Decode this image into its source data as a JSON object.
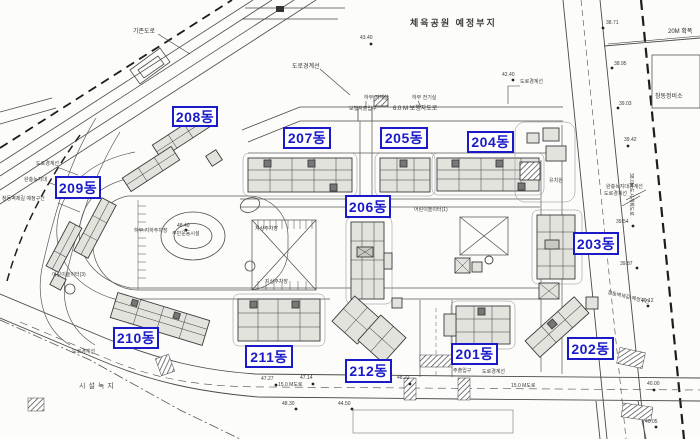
{
  "colors": {
    "label_blue": "#1a1ac8",
    "line_ink": "#3c3c3c",
    "building_fill": "#e3e3de"
  },
  "building_labels": [
    {
      "id": "208",
      "text": "208동"
    },
    {
      "id": "207",
      "text": "207동"
    },
    {
      "id": "205",
      "text": "205동"
    },
    {
      "id": "204",
      "text": "204동"
    },
    {
      "id": "209",
      "text": "209동"
    },
    {
      "id": "206",
      "text": "206동"
    },
    {
      "id": "203",
      "text": "203동"
    },
    {
      "id": "210",
      "text": "210동"
    },
    {
      "id": "211",
      "text": "211동"
    },
    {
      "id": "212",
      "text": "212동"
    },
    {
      "id": "201",
      "text": "201동"
    },
    {
      "id": "202",
      "text": "202동"
    }
  ],
  "annotations": [
    {
      "text": "기존도로"
    },
    {
      "text": "체육공원 예정부지"
    },
    {
      "text": "도로경계선"
    },
    {
      "text": "하부 기계실"
    },
    {
      "text": "하부 전기실"
    },
    {
      "text": "보행자출입구"
    },
    {
      "text": "6.0 M 보행자도로"
    },
    {
      "text": "43.40"
    },
    {
      "text": "42.40"
    },
    {
      "text": "도로경계선"
    },
    {
      "text": "20M 확폭"
    },
    {
      "text": "38.71"
    },
    {
      "text": "38.95"
    },
    {
      "text": "39.03"
    },
    {
      "text": "창동정비소"
    },
    {
      "text": "도로경계선"
    },
    {
      "text": "완충녹지대"
    },
    {
      "text": "창동벽제길 예정구간"
    },
    {
      "text": "완충녹지대경계선"
    },
    {
      "text": "도로경계선"
    },
    {
      "text": "39.42"
    },
    {
      "text": "38.0M 도시계획도로"
    },
    {
      "text": "39.54"
    },
    {
      "text": "39.87"
    },
    {
      "text": "유치원"
    },
    {
      "text": "어린이놀이터(1)"
    },
    {
      "text": "주민운동시설"
    },
    {
      "text": "48.40"
    },
    {
      "text": "하부:지하주차장"
    },
    {
      "text": "지상주차장"
    },
    {
      "text": "지상주차장"
    },
    {
      "text": "어린이놀이터(3)"
    },
    {
      "text": "창동벽제길 예정구간"
    },
    {
      "text": "도로경계선"
    },
    {
      "text": "시설녹지"
    },
    {
      "text": "47.27"
    },
    {
      "text": "47.14"
    },
    {
      "text": "48.22"
    },
    {
      "text": "15.0 M도로"
    },
    {
      "text": "48.30"
    },
    {
      "text": "44.50"
    },
    {
      "text": "주출입구"
    },
    {
      "text": "도로경계선"
    },
    {
      "text": "15.0 M도로"
    },
    {
      "text": "40.12"
    },
    {
      "text": "40.00"
    },
    {
      "text": "40.05"
    }
  ]
}
